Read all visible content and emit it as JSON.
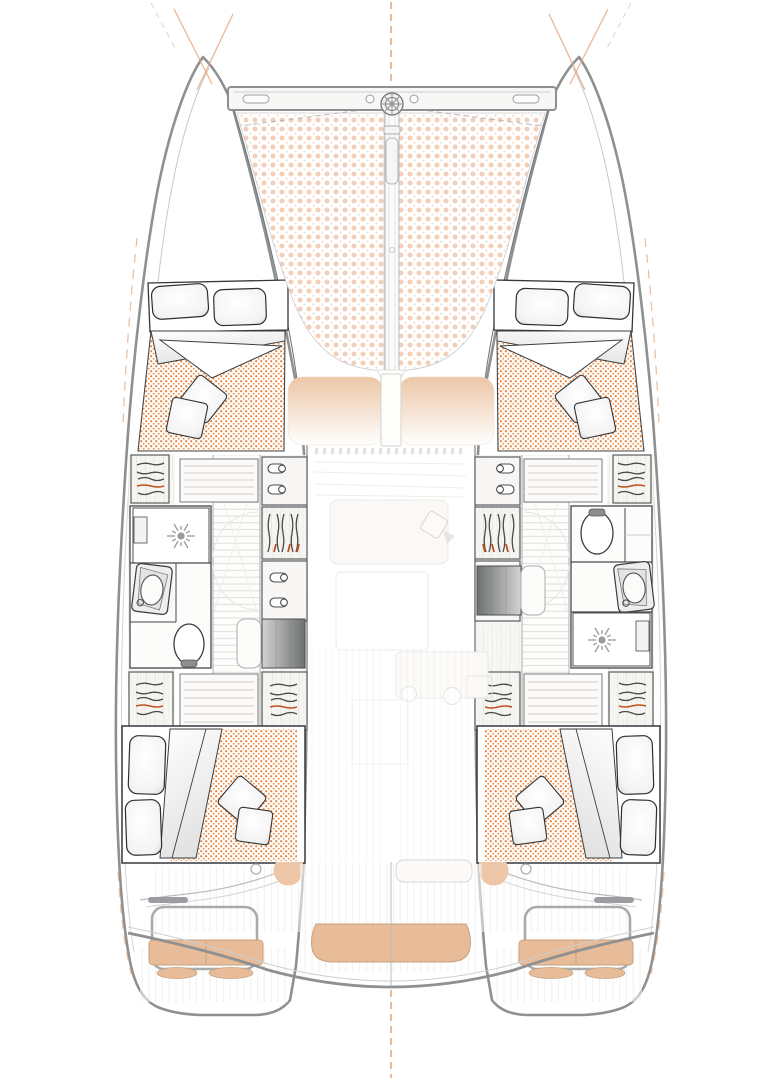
{
  "document": {
    "title": "Catamaran accommodation plan — top view",
    "type": "yacht deck and accommodation floor plan, no visible text labels"
  },
  "vessel": {
    "kind": "sailing catamaran",
    "layout": "4 double cabins, 2 bathrooms, ghosted saloon on bridge deck",
    "symmetry": "port and starboard hulls mirrored about centerline"
  },
  "counts": {
    "double_beds": 4,
    "bed_pillows": 8,
    "throw_pillows": 8,
    "bathrooms": 2,
    "showers": 2,
    "washbasins": 2,
    "toilets": 2,
    "companionway_steps": 2,
    "wardrobes_with_hangers": 8,
    "locker_cabinets_with_handles": 6,
    "helm_bench_seats": 2,
    "aft_bench_seats": 1
  },
  "features": {
    "bow": [
      "forward crossbeam",
      "anchor windlass fitting",
      "central bowsprit channel",
      "trampoline net (dotted)",
      "bridle lines (dashed)",
      "bow centerline cross marks"
    ],
    "midship": [
      "forward island beds with folded duvets",
      "hull corridors with plank flooring",
      "hanging wardrobes",
      "handle lockers",
      "companionway steps (grey gradient)"
    ],
    "saloon": [
      "coachroof window tan shading",
      "mast support post",
      "ghosted saloon and galley furniture",
      "ghost sink circles"
    ],
    "stern": [
      "aft island beds",
      "cockpit plank decking",
      "central aft bench",
      "port and starboard helm benches with footrest pads",
      "grab rails",
      "swim transoms",
      "aft centerline"
    ]
  },
  "colors": {
    "hull_outline": "#8e9091",
    "furniture_line": "#3f4245",
    "mattress_dot_a": "#e8813c",
    "mattress_dot_b": "#ef9a55",
    "trampoline_dot_a": "#f3cfb8",
    "trampoline_dot_b": "#f7ddcc",
    "seat_tan": "#e8bc98",
    "seat_tan_edge": "#c9a27f",
    "deck_pad_tan": "#ecc6a6",
    "steps_light": "#d2d2d2",
    "steps_dark": "#6e7071",
    "plank_line": "#dcdad6",
    "wood_line": "#e7e5e1",
    "centerline_orange": "#e59b70",
    "bow_cross_orange": "#eba87f",
    "hanger_accent": "#c0511f",
    "ghost_line": "#e9e7e2",
    "rail_grey": "#a7abad"
  }
}
